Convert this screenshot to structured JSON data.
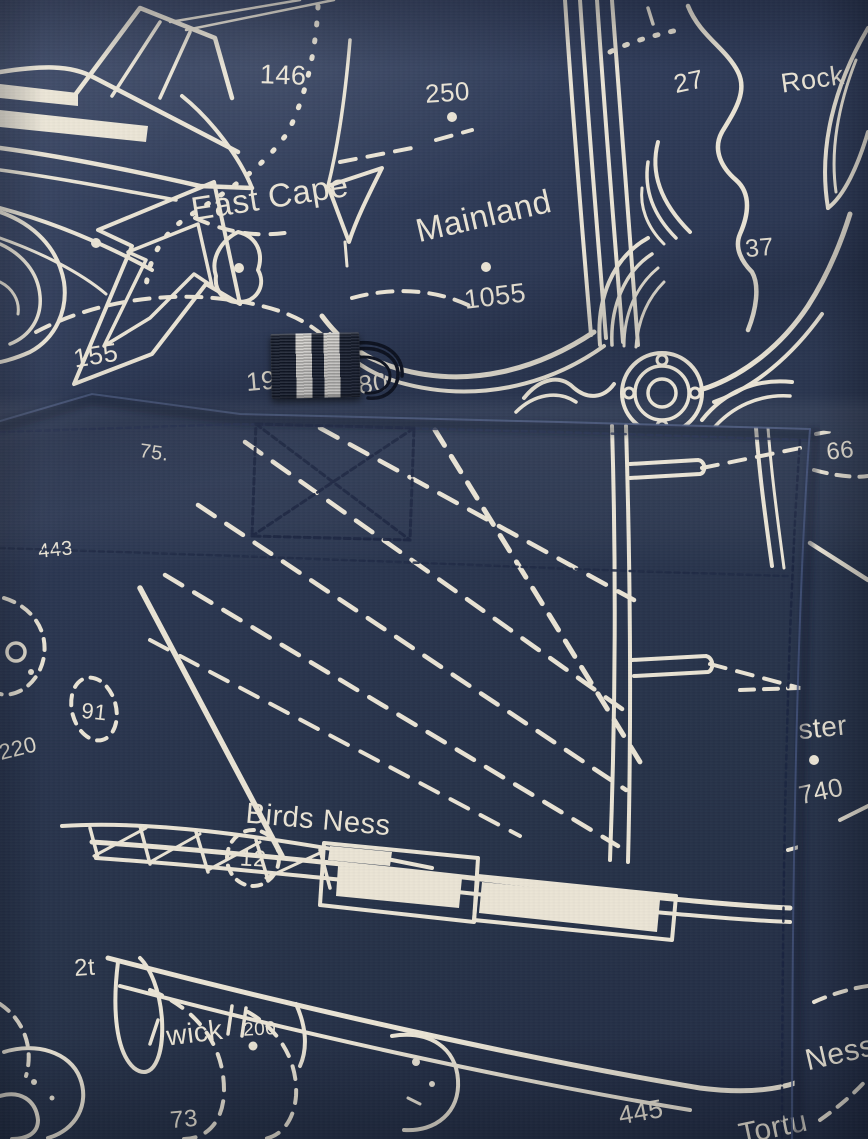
{
  "scene": {
    "description": "Close-up photograph of navy swim shorts back pocket; fabric printed with a white nautical chart pattern (anchor, boats, coastlines, depth soundings); navy grosgrain tab with two white stripes and a black cord loop at the pocket opening",
    "garment": "swim shorts",
    "pattern": "nautical chart print"
  },
  "colors": {
    "fabric-navy": "#2c3853",
    "fabric-navy-light": "#3a4866",
    "fabric-navy-dark": "#202a40",
    "print-cream": "#eae4d5",
    "tab-navy": "#151c2d",
    "tab-stripe-white": "#dfdcd7",
    "cord-black": "#0d1220",
    "stitch-navy": "#1a2440"
  },
  "print_labels": {
    "num_146": "146",
    "num_250": "250",
    "east_cape": "East Cape",
    "mainland": "Mainland",
    "num_1055": "1055",
    "num_27": "27",
    "rock": "Rock",
    "num_37": "37",
    "num_155": "155",
    "num_19": "19",
    "num_80": "80",
    "num_66": "66",
    "num_75": "75.",
    "num_443": "443",
    "num_91": "91",
    "num_220": "220",
    "birds_ness": "Birds Ness",
    "num_12": "12",
    "ster": "ster",
    "num_740": "740",
    "num_2t": "2t",
    "wick": "wick",
    "num_200": "200",
    "num_73": "73",
    "num_445": "445",
    "ness": "Ness",
    "tortu": "Tortu"
  }
}
